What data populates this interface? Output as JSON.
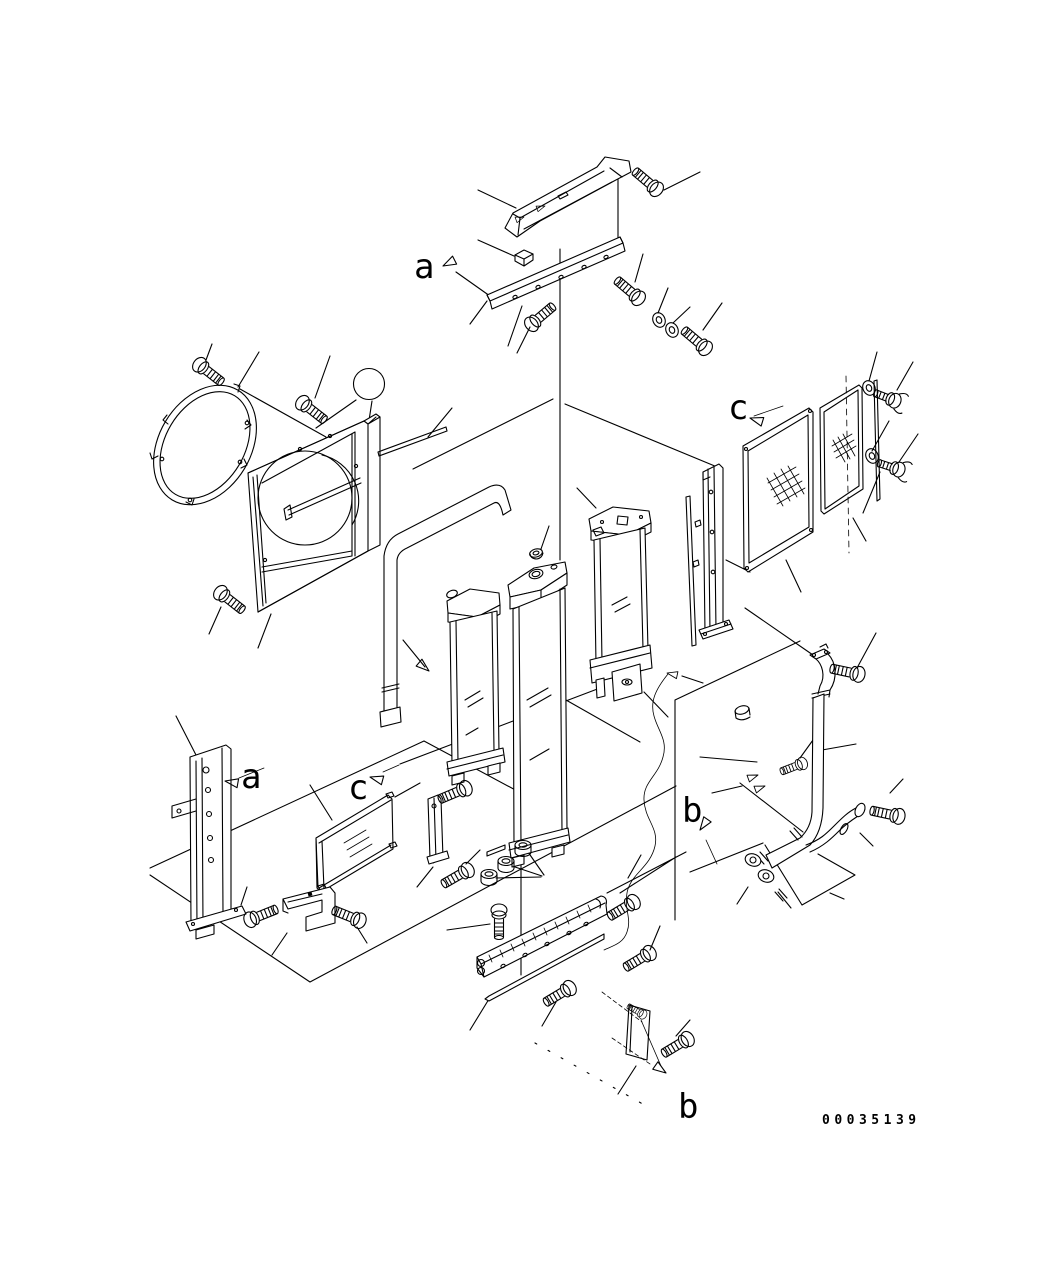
{
  "figure": {
    "badge": {
      "label": "35",
      "fill": "#118011",
      "text_color": "#ffffff",
      "ring_color": "#000000"
    },
    "view_labels": {
      "a_top": "a",
      "a_bottom": "a",
      "b_right": "b",
      "b_bottom": "b",
      "c_top": "c",
      "c_bottom": "c"
    },
    "part_number": "00035139"
  }
}
